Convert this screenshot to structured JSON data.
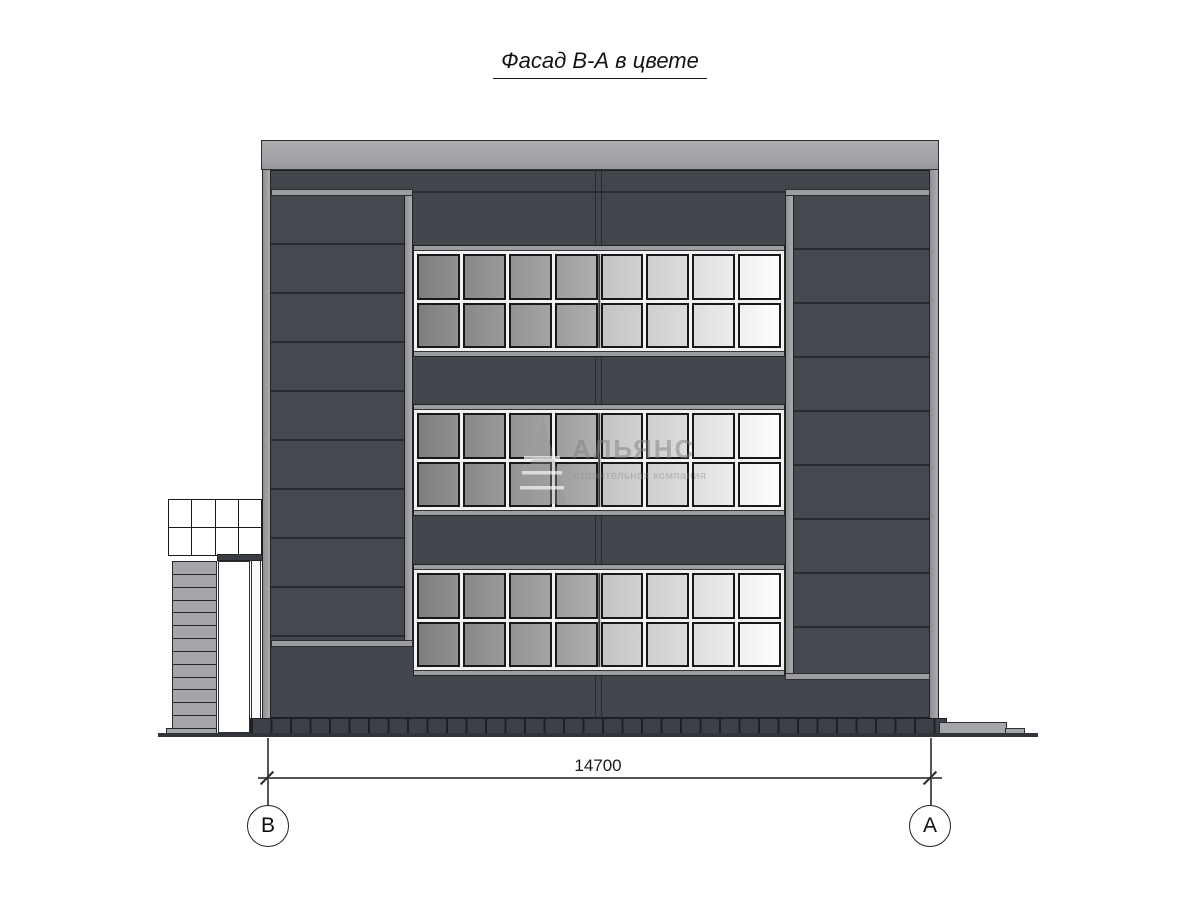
{
  "title": "Фасад В-А в цвете",
  "watermark": {
    "name": "АЛЬЯНС",
    "tagline": "строительная компания",
    "logo": "triangle-sail-logo"
  },
  "dimension": {
    "value": "14700"
  },
  "axis_markers": {
    "left": "В",
    "right": "А"
  },
  "structure": {
    "window_bands": 3,
    "window_cols": 8,
    "window_rows": 2,
    "stair_steps": 13,
    "stair_grid_cols": 4,
    "stair_grid_rows": 2,
    "plinth_segments": 36
  },
  "colors": {
    "facade": "#42464c",
    "parapet": "#a0a2a5",
    "mullion_light": "#9b9da0",
    "panel_joint": "#282b2f",
    "window_frame": "#f2f2f2",
    "pane_border": "#17181a",
    "pane_darkest": "#7e7e7e",
    "pane_lightest": "#fdfdfd",
    "plinth": "#3d4147",
    "ground": "#313438",
    "step": "#a4a6a9",
    "drawing_line": "#555555"
  }
}
